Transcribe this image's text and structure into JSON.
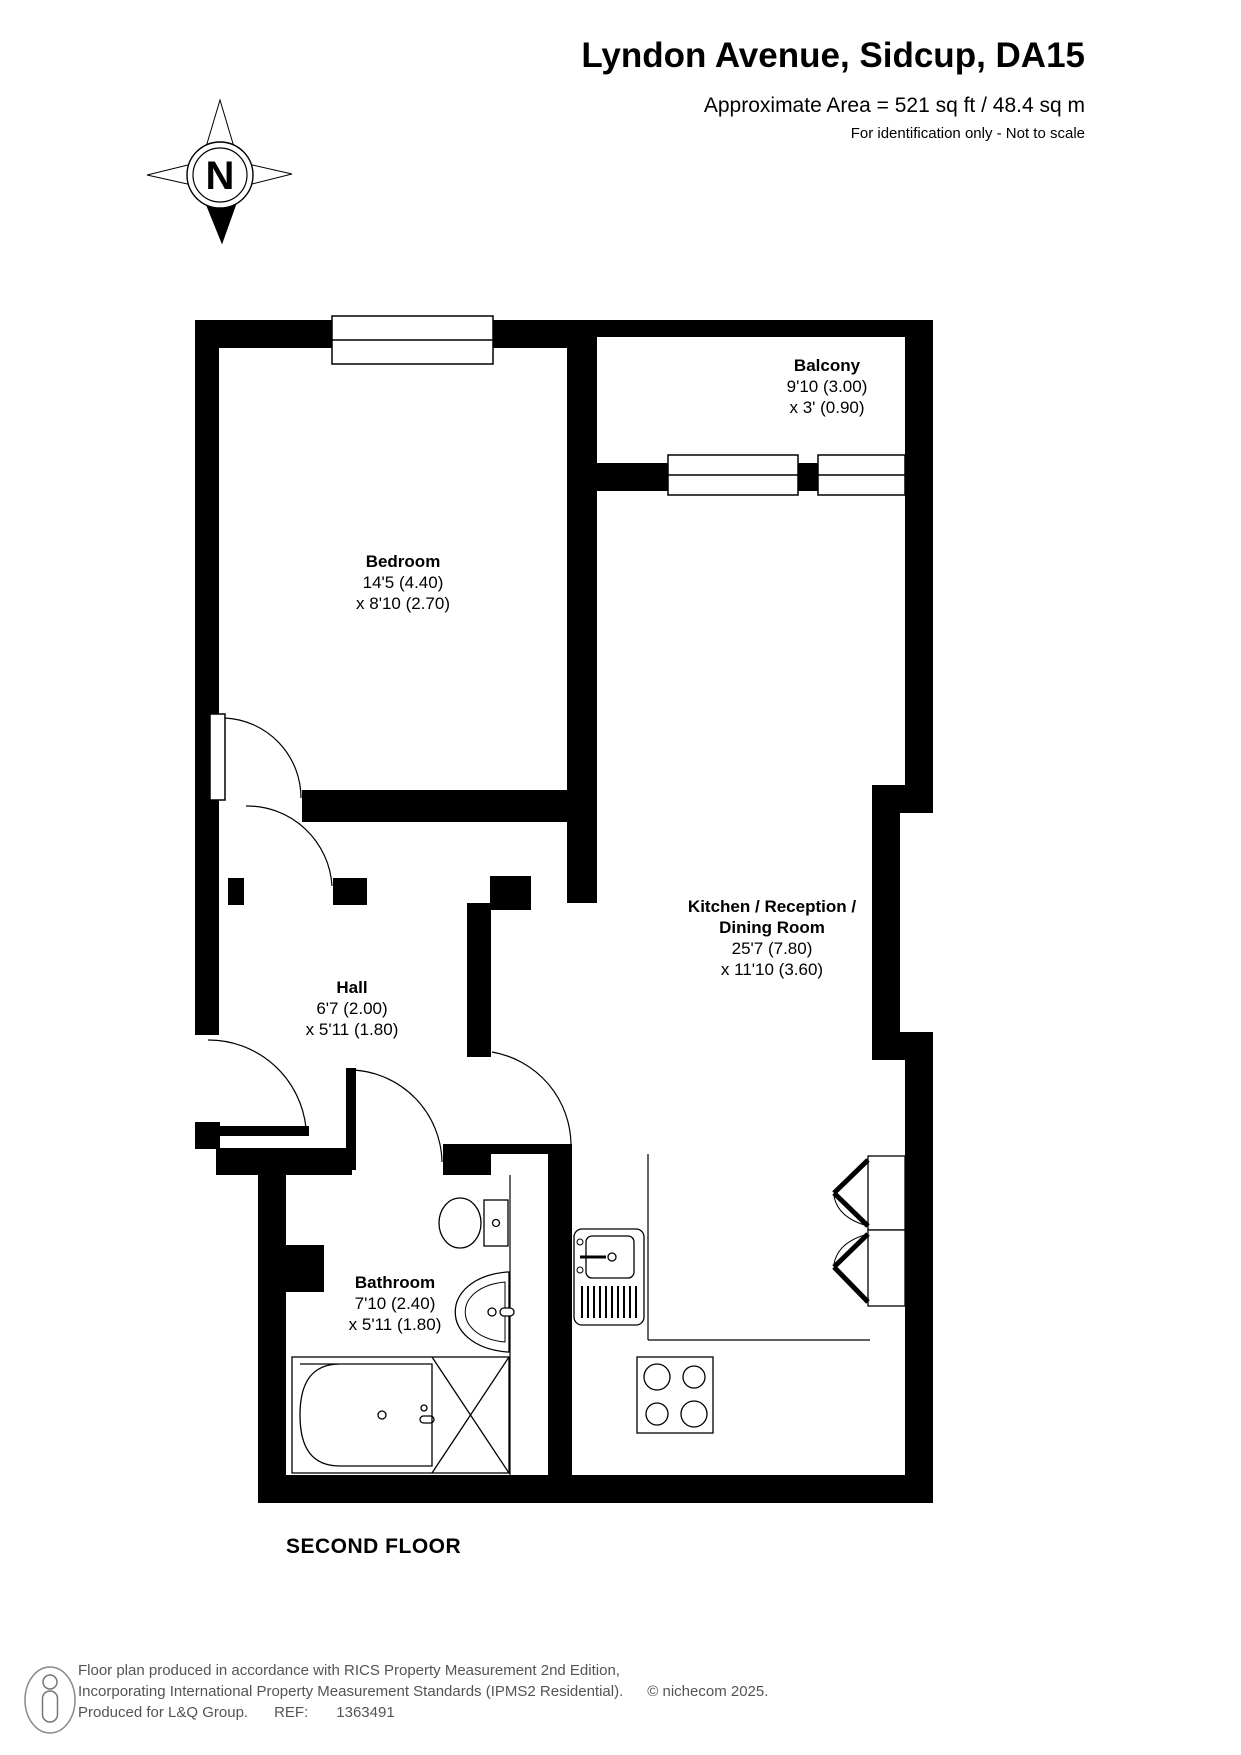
{
  "header": {
    "title": "Lyndon Avenue, Sidcup, DA15",
    "area": "Approximate Area = 521 sq ft / 48.4 sq m",
    "disclaimer": "For identification only - Not to scale"
  },
  "compass": {
    "north_label": "N"
  },
  "rooms": {
    "balcony": {
      "name": "Balcony",
      "dim1": "9'10 (3.00)",
      "dim2": "x 3' (0.90)"
    },
    "bedroom": {
      "name": "Bedroom",
      "dim1": "14'5 (4.40)",
      "dim2": "x 8'10 (2.70)"
    },
    "kitchen": {
      "name_line1": "Kitchen / Reception /",
      "name_line2": "Dining Room",
      "dim1": "25'7 (7.80)",
      "dim2": "x 11'10 (3.60)"
    },
    "hall": {
      "name": "Hall",
      "dim1": "6'7 (2.00)",
      "dim2": "x 5'11 (1.80)"
    },
    "bathroom": {
      "name": "Bathroom",
      "dim1": "7'10 (2.40)",
      "dim2": "x 5'11 (1.80)"
    }
  },
  "floor": {
    "label": "SECOND FLOOR"
  },
  "footer": {
    "line1": "Floor plan produced in accordance with RICS Property Measurement 2nd Edition,",
    "line2": "Incorporating International Property Measurement Standards (IPMS2 Residential).",
    "copyright": "© nichecom 2025.",
    "produced_for": "Produced for L&Q Group.",
    "ref_label": "REF:",
    "ref_number": "1363491"
  }
}
